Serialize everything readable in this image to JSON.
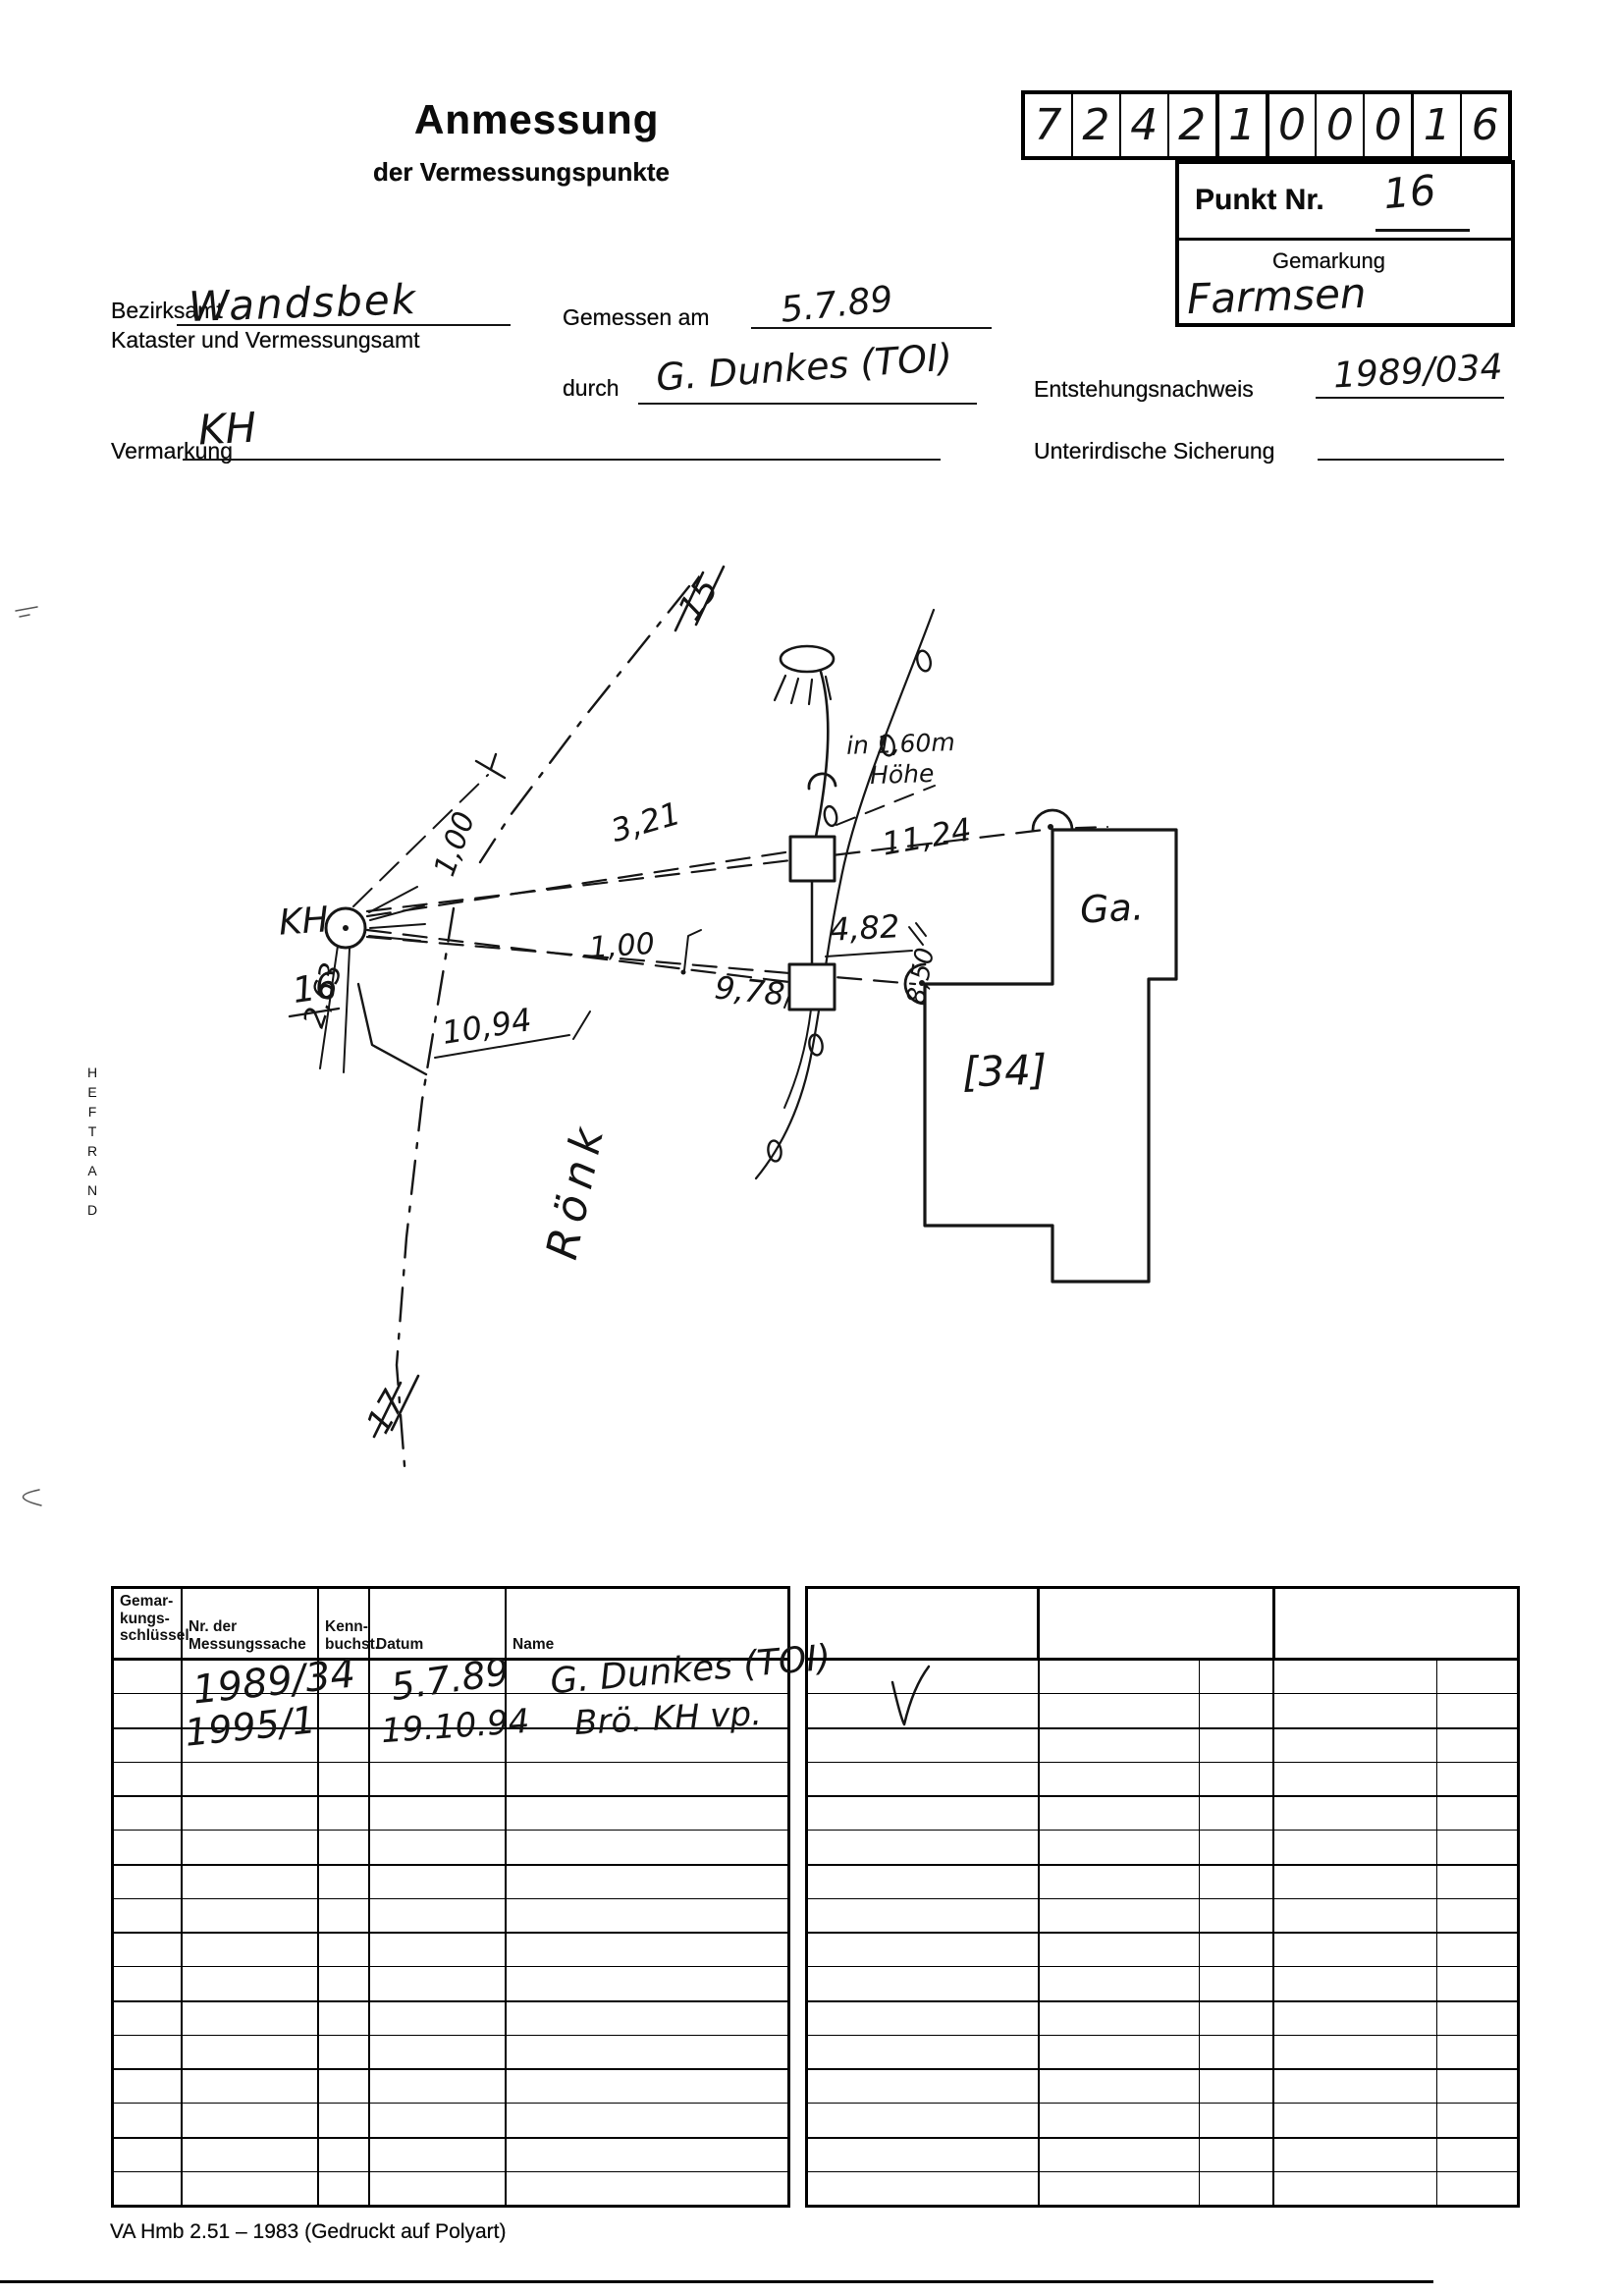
{
  "header": {
    "code_digits": [
      "7",
      "2",
      "4",
      "2",
      "1",
      "0",
      "0",
      "0",
      "1",
      "6"
    ],
    "punkt_label": "Punkt Nr.",
    "punkt_value": "16",
    "gemarkung_label": "Gemarkung",
    "gemarkung_value": "Farmsen",
    "title": "Anmessung",
    "subtitle": "der Vermessungspunkte"
  },
  "form": {
    "bezirksamt_label": "Bezirksamt",
    "bezirksamt_value": "Wandsbek",
    "kataster_label": "Kataster und Vermessungsamt",
    "gemessen_label": "Gemessen am",
    "gemessen_value": "5.7.89",
    "durch_label": "durch",
    "durch_value": "G. Dunkes (TOI)",
    "entstehung_label": "Entstehungsnachweis",
    "entstehung_value": "1989/034",
    "vermarkung_label": "Vermarkung",
    "vermarkung_value": "KH",
    "sicherung_label": "Unterirdische Sicherung",
    "sicherung_value": ""
  },
  "margin": {
    "heftrand": "HEFTRAND"
  },
  "sketch": {
    "labels": {
      "house15": "15",
      "house17": "17",
      "hoehe_line1": "in 1,60m",
      "hoehe_line2": "Höhe",
      "point_name": "KH",
      "point_number": "16",
      "m_100_vert": "1,00",
      "m_263": "2,63",
      "m_1094": "10,94",
      "m_100_horiz": "1,00",
      "m_321": "3,21",
      "m_1124": "11,24",
      "m_978": "9,78",
      "m_482": "4,82",
      "m_850": "8,50",
      "garage": "Ga.",
      "house34": "[34]",
      "street": "Rönk"
    }
  },
  "table_left": {
    "headers": [
      "Gemar-\nkungs-\nschlüssel",
      "Nr. der\nMessungssache",
      "Kenn-\nbuchst.",
      "Datum",
      "Name"
    ],
    "rows": [
      {
        "messungssache": "1989/34",
        "datum": "5.7.89",
        "name": "G. Dunkes (TOI)"
      },
      {
        "messungssache": "1995/1",
        "datum": "19.10.94",
        "name": "Brö. KH vp."
      }
    ],
    "empty_row_count": 16
  },
  "table_right": {
    "empty_row_count": 16
  },
  "footer": {
    "form_id": "VA Hmb 2.51 – 1983 (Gedruckt auf Polyart)"
  }
}
